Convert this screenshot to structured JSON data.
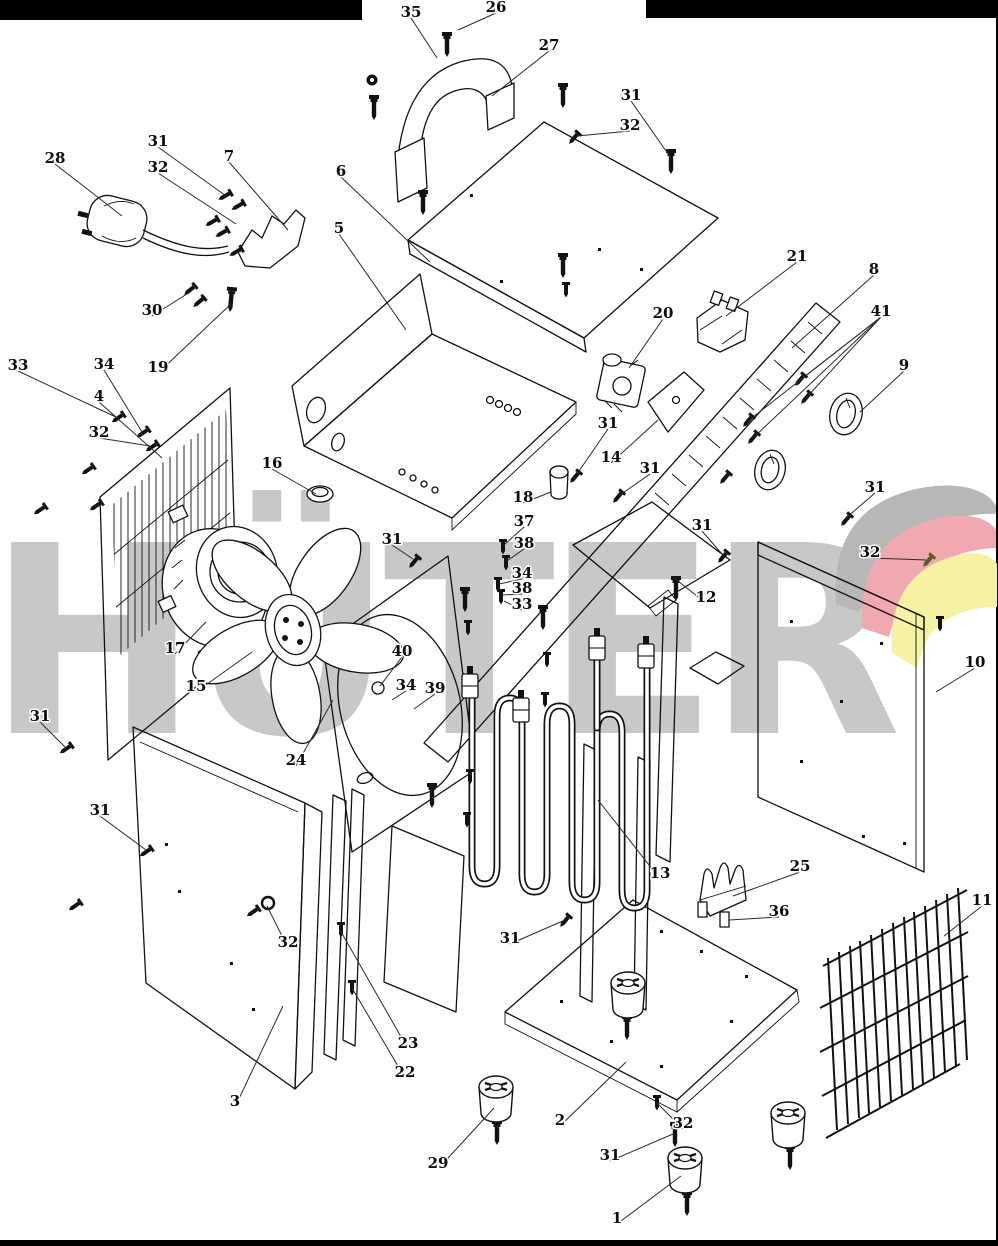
{
  "watermark": {
    "text": "HÜTER",
    "color": "#c8c8c8"
  },
  "logo": {
    "gray": "#b7b7b7",
    "pink": "#f0a9b0",
    "yellow": "#f5f2a4"
  },
  "bars": {
    "color": "#000000"
  },
  "labels": [
    {
      "t": "35",
      "x": 411,
      "y": 13,
      "lx": 437,
      "ly": 58
    },
    {
      "t": "26",
      "x": 496,
      "y": 8,
      "lx": 458,
      "ly": 30
    },
    {
      "t": "27",
      "x": 549,
      "y": 46,
      "lx": 492,
      "ly": 96
    },
    {
      "t": "31",
      "x": 631,
      "y": 96,
      "lx": 671,
      "ly": 158
    },
    {
      "t": "32",
      "x": 630,
      "y": 126,
      "lx": 577,
      "ly": 136
    },
    {
      "t": "28",
      "x": 55,
      "y": 159,
      "lx": 122,
      "ly": 216
    },
    {
      "t": "31",
      "x": 158,
      "y": 142,
      "lx": 226,
      "ly": 196
    },
    {
      "t": "32",
      "x": 158,
      "y": 168,
      "lx": 236,
      "ly": 224
    },
    {
      "t": "7",
      "x": 229,
      "y": 157,
      "lx": 288,
      "ly": 230
    },
    {
      "t": "6",
      "x": 341,
      "y": 172,
      "lx": 430,
      "ly": 262
    },
    {
      "t": "5",
      "x": 339,
      "y": 229,
      "lx": 406,
      "ly": 330
    },
    {
      "t": "21",
      "x": 797,
      "y": 257,
      "lx": 726,
      "ly": 316
    },
    {
      "t": "8",
      "x": 874,
      "y": 270,
      "lx": 792,
      "ly": 348
    },
    {
      "t": "20",
      "x": 663,
      "y": 314,
      "lx": 629,
      "ly": 368
    },
    {
      "t": "41",
      "x": 881,
      "y": 312,
      "lx": 800,
      "ly": 380,
      "ex": [
        [
          806,
          398
        ],
        [
          748,
          421
        ],
        [
          753,
          438
        ]
      ]
    },
    {
      "t": "9",
      "x": 904,
      "y": 366,
      "lx": 860,
      "ly": 412
    },
    {
      "t": "30",
      "x": 152,
      "y": 311,
      "lx": 190,
      "ly": 292
    },
    {
      "t": "19",
      "x": 158,
      "y": 368,
      "lx": 232,
      "ly": 303
    },
    {
      "t": "33",
      "x": 18,
      "y": 366,
      "lx": 118,
      "ly": 418
    },
    {
      "t": "34",
      "x": 104,
      "y": 365,
      "lx": 142,
      "ly": 432
    },
    {
      "t": "4",
      "x": 99,
      "y": 397,
      "lx": 162,
      "ly": 458
    },
    {
      "t": "32",
      "x": 99,
      "y": 433,
      "lx": 150,
      "ly": 446
    },
    {
      "t": "16",
      "x": 272,
      "y": 464,
      "lx": 316,
      "ly": 494
    },
    {
      "t": "31",
      "x": 392,
      "y": 540,
      "lx": 413,
      "ly": 559
    },
    {
      "t": "18",
      "x": 523,
      "y": 498,
      "lx": 551,
      "ly": 492
    },
    {
      "t": "37",
      "x": 524,
      "y": 522,
      "lx": 504,
      "ly": 545
    },
    {
      "t": "38",
      "x": 524,
      "y": 544,
      "lx": 507,
      "ly": 561
    },
    {
      "t": "31",
      "x": 608,
      "y": 424,
      "lx": 577,
      "ly": 474
    },
    {
      "t": "14",
      "x": 611,
      "y": 458,
      "lx": 658,
      "ly": 420
    },
    {
      "t": "31",
      "x": 650,
      "y": 469,
      "lx": 620,
      "ly": 495
    },
    {
      "t": "34",
      "x": 522,
      "y": 574,
      "lx": 499,
      "ly": 584
    },
    {
      "t": "38",
      "x": 522,
      "y": 589,
      "lx": 502,
      "ly": 595
    },
    {
      "t": "33",
      "x": 522,
      "y": 605,
      "lx": 504,
      "ly": 601
    },
    {
      "t": "31",
      "x": 702,
      "y": 526,
      "lx": 722,
      "ly": 554
    },
    {
      "t": "12",
      "x": 706,
      "y": 598,
      "lx": 674,
      "ly": 578
    },
    {
      "t": "40",
      "x": 402,
      "y": 652,
      "lx": 380,
      "ly": 686
    },
    {
      "t": "34",
      "x": 406,
      "y": 686,
      "lx": 392,
      "ly": 700
    },
    {
      "t": "39",
      "x": 435,
      "y": 689,
      "lx": 414,
      "ly": 709
    },
    {
      "t": "17",
      "x": 175,
      "y": 649,
      "lx": 206,
      "ly": 622
    },
    {
      "t": "15",
      "x": 196,
      "y": 687,
      "lx": 252,
      "ly": 652
    },
    {
      "t": "24",
      "x": 296,
      "y": 761,
      "lx": 333,
      "ly": 700
    },
    {
      "t": "31",
      "x": 40,
      "y": 717,
      "lx": 65,
      "ly": 747
    },
    {
      "t": "31",
      "x": 100,
      "y": 811,
      "lx": 146,
      "ly": 850
    },
    {
      "t": "32",
      "x": 288,
      "y": 943,
      "lx": 267,
      "ly": 906
    },
    {
      "t": "23",
      "x": 408,
      "y": 1044,
      "lx": 340,
      "ly": 930
    },
    {
      "t": "22",
      "x": 405,
      "y": 1073,
      "lx": 352,
      "ly": 988
    },
    {
      "t": "3",
      "x": 235,
      "y": 1102,
      "lx": 283,
      "ly": 1006
    },
    {
      "t": "31",
      "x": 510,
      "y": 939,
      "lx": 565,
      "ly": 920
    },
    {
      "t": "2",
      "x": 560,
      "y": 1121,
      "lx": 626,
      "ly": 1062
    },
    {
      "t": "29",
      "x": 438,
      "y": 1164,
      "lx": 494,
      "ly": 1108
    },
    {
      "t": "31",
      "x": 610,
      "y": 1156,
      "lx": 673,
      "ly": 1134
    },
    {
      "t": "32",
      "x": 683,
      "y": 1124,
      "lx": 657,
      "ly": 1103
    },
    {
      "t": "1",
      "x": 617,
      "y": 1219,
      "lx": 681,
      "ly": 1176
    },
    {
      "t": "13",
      "x": 660,
      "y": 874,
      "lx": 598,
      "ly": 800
    },
    {
      "t": "25",
      "x": 800,
      "y": 867,
      "lx": 733,
      "ly": 896
    },
    {
      "t": "36",
      "x": 779,
      "y": 912,
      "lx": 729,
      "ly": 920
    },
    {
      "t": "11",
      "x": 982,
      "y": 901,
      "lx": 944,
      "ly": 936
    },
    {
      "t": "10",
      "x": 975,
      "y": 663,
      "lx": 936,
      "ly": 692
    },
    {
      "t": "31",
      "x": 875,
      "y": 488,
      "lx": 846,
      "ly": 518
    },
    {
      "t": "32",
      "x": 870,
      "y": 553,
      "lx": 926,
      "ly": 560
    }
  ],
  "screws": [
    {
      "x": 372,
      "y": 80,
      "t": "nut"
    },
    {
      "x": 374,
      "y": 108,
      "t": "bolt"
    },
    {
      "x": 447,
      "y": 45,
      "t": "bolt"
    },
    {
      "x": 563,
      "y": 96,
      "t": "bolt"
    },
    {
      "x": 574,
      "y": 138,
      "t": "sm",
      "a": 40
    },
    {
      "x": 671,
      "y": 162,
      "t": "bolt"
    },
    {
      "x": 423,
      "y": 203,
      "t": "bolt"
    },
    {
      "x": 563,
      "y": 266,
      "t": "bolt"
    },
    {
      "x": 566,
      "y": 290,
      "t": "sm"
    },
    {
      "x": 225,
      "y": 196,
      "t": "sm",
      "a": 60
    },
    {
      "x": 238,
      "y": 206,
      "t": "sm",
      "a": 60
    },
    {
      "x": 212,
      "y": 222,
      "t": "sm",
      "a": 60
    },
    {
      "x": 222,
      "y": 233,
      "t": "sm",
      "a": 60
    },
    {
      "x": 236,
      "y": 252,
      "t": "sm",
      "a": 60
    },
    {
      "x": 190,
      "y": 290,
      "t": "sm",
      "a": 50
    },
    {
      "x": 199,
      "y": 302,
      "t": "sm",
      "a": 50
    },
    {
      "x": 231,
      "y": 300,
      "t": "bolt",
      "a": 5
    },
    {
      "x": 118,
      "y": 418,
      "t": "sm",
      "a": 55
    },
    {
      "x": 143,
      "y": 433,
      "t": "sm",
      "a": 55
    },
    {
      "x": 152,
      "y": 447,
      "t": "sm",
      "a": 55
    },
    {
      "x": 88,
      "y": 470,
      "t": "sm",
      "a": 55
    },
    {
      "x": 96,
      "y": 506,
      "t": "sm",
      "a": 55
    },
    {
      "x": 40,
      "y": 510,
      "t": "sm",
      "a": 55
    },
    {
      "x": 66,
      "y": 749,
      "t": "sm",
      "a": 55
    },
    {
      "x": 146,
      "y": 852,
      "t": "sm",
      "a": 55
    },
    {
      "x": 75,
      "y": 906,
      "t": "sm",
      "a": 55
    },
    {
      "x": 253,
      "y": 912,
      "t": "sm",
      "a": 55
    },
    {
      "x": 268,
      "y": 903,
      "t": "washer"
    },
    {
      "x": 414,
      "y": 562,
      "t": "sm",
      "a": 40
    },
    {
      "x": 465,
      "y": 600,
      "t": "bolt"
    },
    {
      "x": 468,
      "y": 628,
      "t": "sm"
    },
    {
      "x": 470,
      "y": 777,
      "t": "sm"
    },
    {
      "x": 467,
      "y": 820,
      "t": "sm"
    },
    {
      "x": 432,
      "y": 796,
      "t": "bolt"
    },
    {
      "x": 503,
      "y": 547,
      "t": "sm"
    },
    {
      "x": 506,
      "y": 563,
      "t": "sm"
    },
    {
      "x": 498,
      "y": 585,
      "t": "sm"
    },
    {
      "x": 501,
      "y": 597,
      "t": "sm"
    },
    {
      "x": 543,
      "y": 618,
      "t": "bolt"
    },
    {
      "x": 547,
      "y": 660,
      "t": "sm"
    },
    {
      "x": 545,
      "y": 700,
      "t": "sm"
    },
    {
      "x": 575,
      "y": 477,
      "t": "sm",
      "a": 40
    },
    {
      "x": 618,
      "y": 497,
      "t": "sm",
      "a": 40
    },
    {
      "x": 676,
      "y": 589,
      "t": "bolt"
    },
    {
      "x": 723,
      "y": 557,
      "t": "sm",
      "a": 40
    },
    {
      "x": 800,
      "y": 380,
      "t": "sm",
      "a": 40
    },
    {
      "x": 806,
      "y": 398,
      "t": "sm",
      "a": 40
    },
    {
      "x": 748,
      "y": 421,
      "t": "sm",
      "a": 40
    },
    {
      "x": 753,
      "y": 438,
      "t": "sm",
      "a": 40
    },
    {
      "x": 725,
      "y": 478,
      "t": "sm",
      "a": 40
    },
    {
      "x": 846,
      "y": 520,
      "t": "sm",
      "a": 40
    },
    {
      "x": 928,
      "y": 561,
      "t": "sm",
      "a": 40,
      "c": "#5f5a1e"
    },
    {
      "x": 940,
      "y": 624,
      "t": "sm"
    },
    {
      "x": 565,
      "y": 921,
      "t": "sm",
      "a": 40
    },
    {
      "x": 341,
      "y": 930,
      "t": "sm"
    },
    {
      "x": 352,
      "y": 988,
      "t": "sm"
    },
    {
      "x": 657,
      "y": 1103,
      "t": "sm"
    },
    {
      "x": 675,
      "y": 1135,
      "t": "bolt"
    },
    {
      "x": 627,
      "y": 1028,
      "t": "bolt"
    },
    {
      "x": 497,
      "y": 1133,
      "t": "bolt"
    },
    {
      "x": 790,
      "y": 1158,
      "t": "bolt"
    },
    {
      "x": 687,
      "y": 1204,
      "t": "bolt"
    }
  ],
  "feet": [
    {
      "x": 628,
      "y": 983
    },
    {
      "x": 496,
      "y": 1087
    },
    {
      "x": 788,
      "y": 1113
    },
    {
      "x": 685,
      "y": 1158
    }
  ]
}
